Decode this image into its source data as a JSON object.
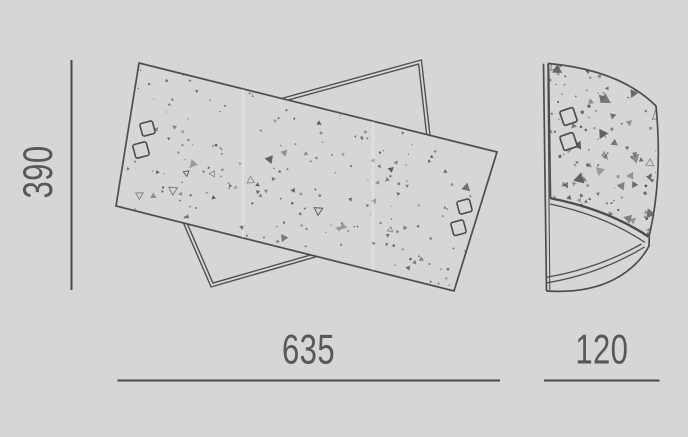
{
  "colors": {
    "background": "#d5d6d5",
    "line": "#4c4d4f",
    "dim_line": "#48484a",
    "text": "#57585b",
    "speckle": "#54555a",
    "seam_highlight": "rgba(255,255,255,0.40)"
  },
  "dimensions": {
    "height": {
      "value": "390",
      "orientation": "vertical",
      "applies_to": "front-view"
    },
    "width": {
      "value": "635",
      "orientation": "horizontal",
      "applies_to": "front-view"
    },
    "depth": {
      "value": "120",
      "orientation": "horizontal",
      "applies_to": "side-view"
    }
  },
  "views": {
    "front": {
      "description": "two crossed rotated rectangular panels, front panel speckled with four square mounting holes"
    },
    "side": {
      "description": "curved wall-lamp profile, speckled face with two square mounting holes and curved bottom rim"
    }
  }
}
